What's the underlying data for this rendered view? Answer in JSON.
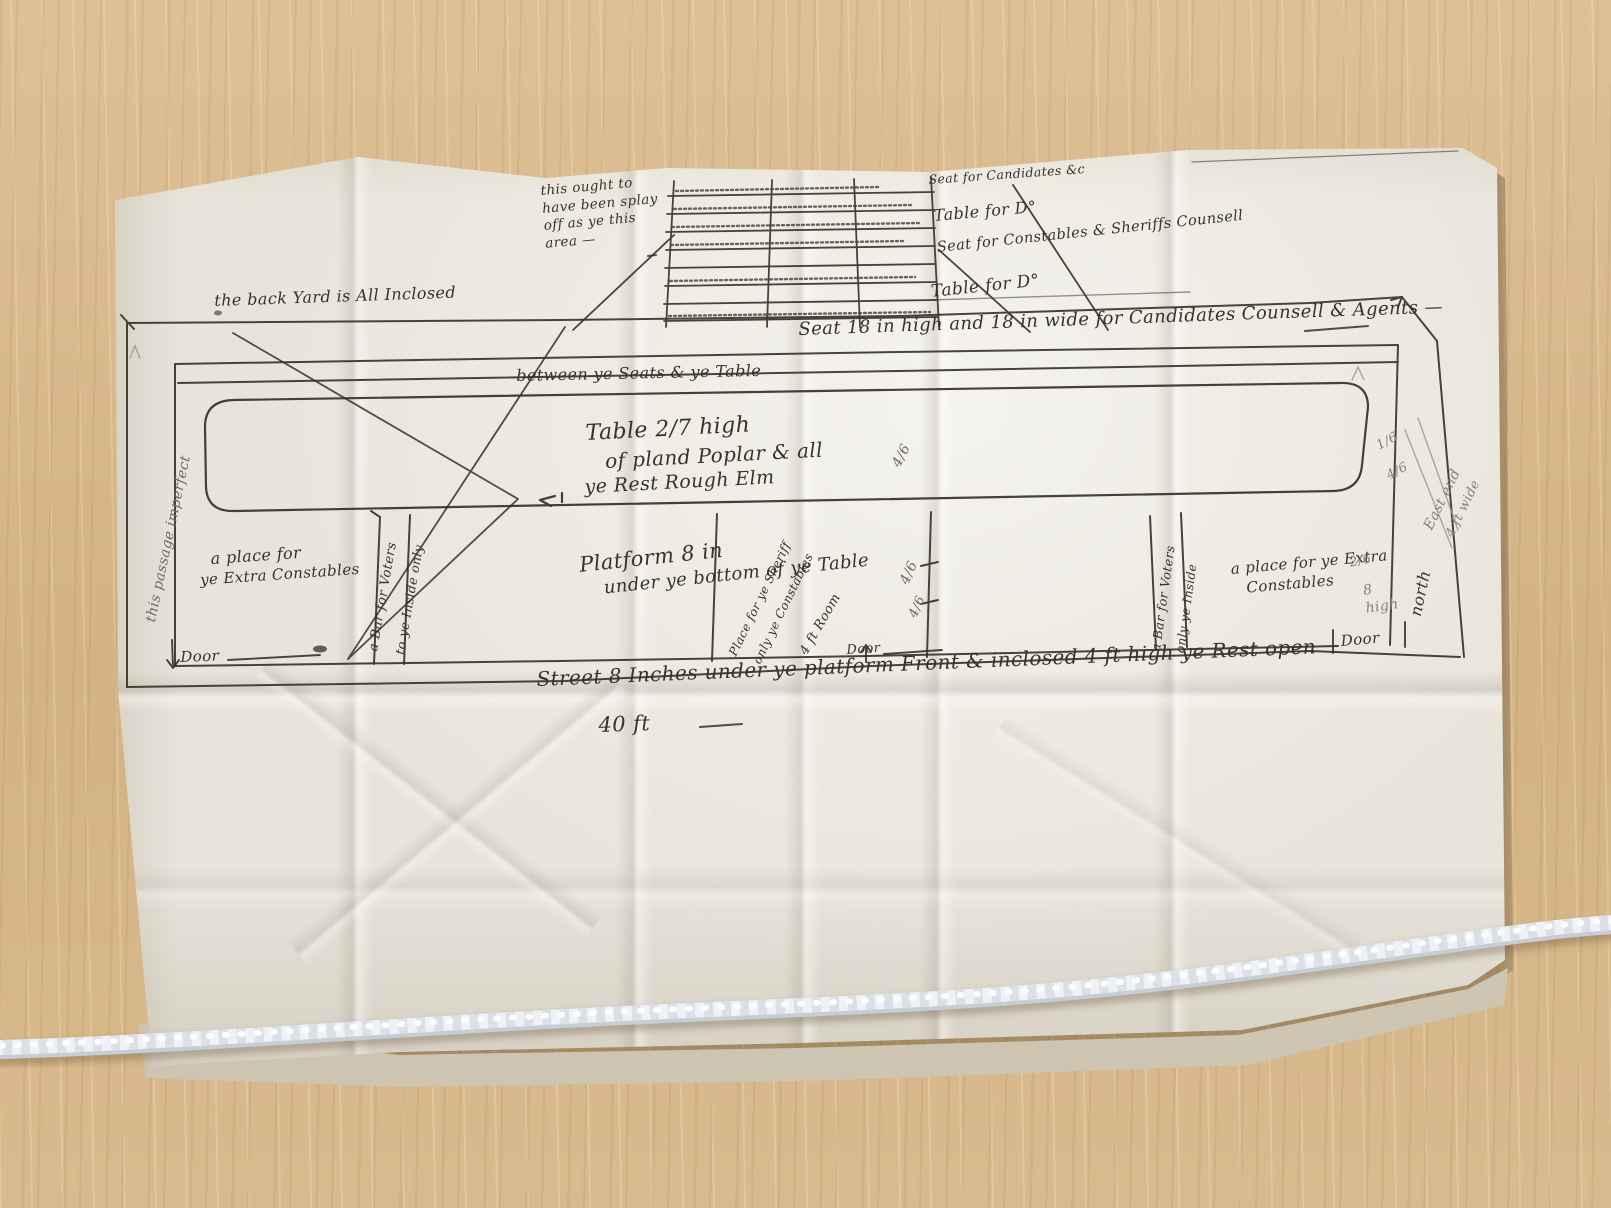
{
  "annotations": {
    "note_area": "this ought to have been splay off as ye this area —",
    "seat_candidates": "Seat for Candidates &c",
    "table_ditto_1": "Table for D°",
    "seat_constables": "Seat for Constables & Sheriffs Counsell",
    "table_ditto_2": "Table for D°",
    "back_yard": "the back Yard is All Inclosed",
    "seat_dims": "Seat 18 in high and 18 in wide for Candidates Counsell & Agents —",
    "between_seats": "between ye Seats & ye Table",
    "table_spec_1": "Table 2/7 high",
    "table_spec_2": "of pland Poplar & all",
    "table_spec_3": "ye Rest Rough Elm",
    "platform_1": "Platform 8 in",
    "platform_2": "under ye bottom of ye Table",
    "diag_place_1": "Place for ye Sheriff",
    "diag_place_2": "only ye Constables",
    "diag_room": "4 ft Room",
    "left_place_1": "a place for",
    "left_place_2": "ye Extra Constables",
    "left_bar_1": "a Bar for Voters",
    "left_bar_2": "to ye Inside only",
    "left_margin": "this passage imperfect",
    "right_bar_1": "a Bar for Voters",
    "right_bar_2": "only ye Inside",
    "right_place_1": "a place for ye Extra",
    "right_place_2": "Constables",
    "north": "north",
    "east_end": "East end",
    "east_width": "4 ft wide",
    "door_left": "Door",
    "door_center": "Door",
    "door_right": "Door",
    "street": "Street 8 Inches under ye platform Front & inclosed 4 ft high ye Rest open",
    "forty_feet": "40 ft",
    "p1": "4/6",
    "p2": "4/6",
    "p3": "4/6",
    "p4": "1/6",
    "p5": "4/6",
    "p6": "2/6",
    "p7": "8 high"
  },
  "colors": {
    "ink": "#363128",
    "pencil": "#87826f",
    "paper": "#e8e4da",
    "wood": "#d8b88c",
    "cord": "#eef1f5"
  }
}
